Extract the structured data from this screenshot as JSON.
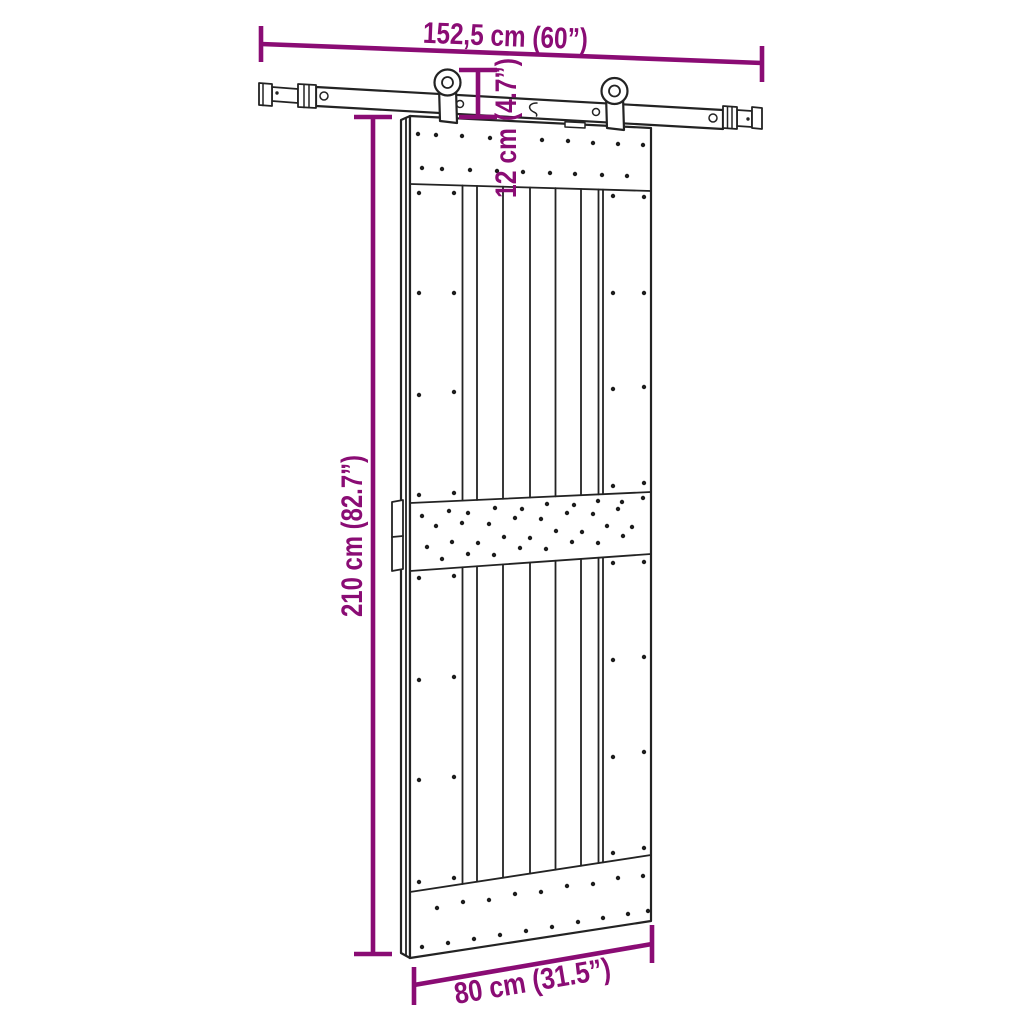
{
  "figure": {
    "kind": "product dimension diagram",
    "subject": "sliding barn door with top-mount rail hardware kit",
    "background_color": "#ffffff",
    "line_color": "#232323",
    "dimension_color": "#8a0c74"
  },
  "dimensions": {
    "rail_length": {
      "label": "152,5 cm (60”)",
      "cm": "152,5",
      "inches": "60"
    },
    "hanger_offset": {
      "label": "12 cm (4.7”)",
      "cm": "12",
      "inches": "4.7"
    },
    "door_height": {
      "label": "210 cm (82.7”)",
      "cm": "210",
      "inches": "82.7"
    },
    "door_width": {
      "label": "80 cm (31.5”)",
      "cm": "80",
      "inches": "31.5"
    }
  }
}
